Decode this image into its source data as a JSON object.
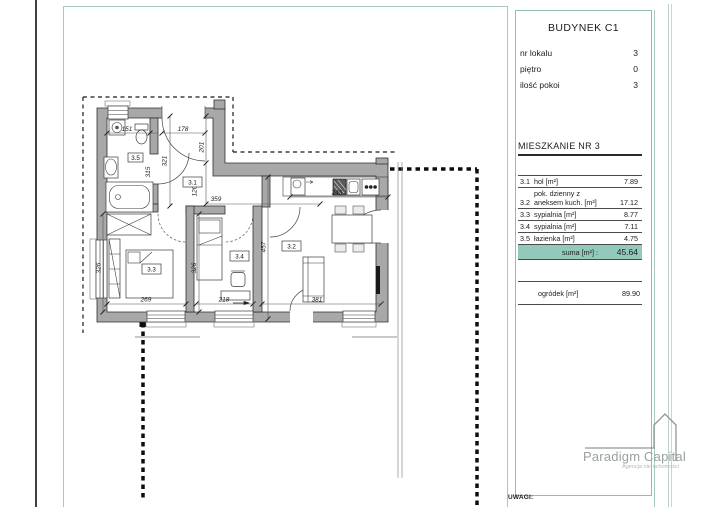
{
  "page": {
    "uwagi": "UWAGI:"
  },
  "sidebar": {
    "title": "BUDYNEK C1",
    "info": [
      {
        "label": "nr lokalu",
        "value": "3"
      },
      {
        "label": "piętro",
        "value": "0"
      },
      {
        "label": "ilość pokoi",
        "value": "3"
      }
    ],
    "section_title": "MIESZKANIE NR  3",
    "rooms": [
      {
        "num": "3.1",
        "name": "hol [m²]",
        "name2": "",
        "area": "7.89"
      },
      {
        "num": "3.2",
        "name": "pok. dzienny z",
        "name2": "aneksem kuch. [m²]",
        "area": "17.12"
      },
      {
        "num": "3.3",
        "name": "sypialnia [m²]",
        "name2": "",
        "area": "8.77"
      },
      {
        "num": "3.4",
        "name": "sypialnia [m²]",
        "name2": "",
        "area": "7.11"
      },
      {
        "num": "3.5",
        "name": "łazienka [m²]",
        "name2": "",
        "area": "4.75"
      }
    ],
    "suma_label": "suma [m²] :",
    "suma_value": "45.64",
    "garden_label": "ogródek [m²]",
    "garden_value": "89.90"
  },
  "plan": {
    "room_labels": {
      "r31": "3.1",
      "r32": "3.2",
      "r33": "3.3",
      "r34": "3.4",
      "r35": "3.5"
    },
    "dims": {
      "d151": "151",
      "d178": "178",
      "d201": "201",
      "d120": "120",
      "d321": "321",
      "d315": "315",
      "d359": "359",
      "d245": "245",
      "d326_33": "326",
      "d269": "269",
      "d326_34": "326",
      "d218": "218",
      "d457": "457",
      "d381": "381"
    }
  },
  "logo": {
    "name": "Paradigm Capital",
    "tagline": "Agencja nieruchomości"
  },
  "colors": {
    "accent": "#93c9bb",
    "frame": "#a5c8c3",
    "wall": "#a8a8a8"
  }
}
